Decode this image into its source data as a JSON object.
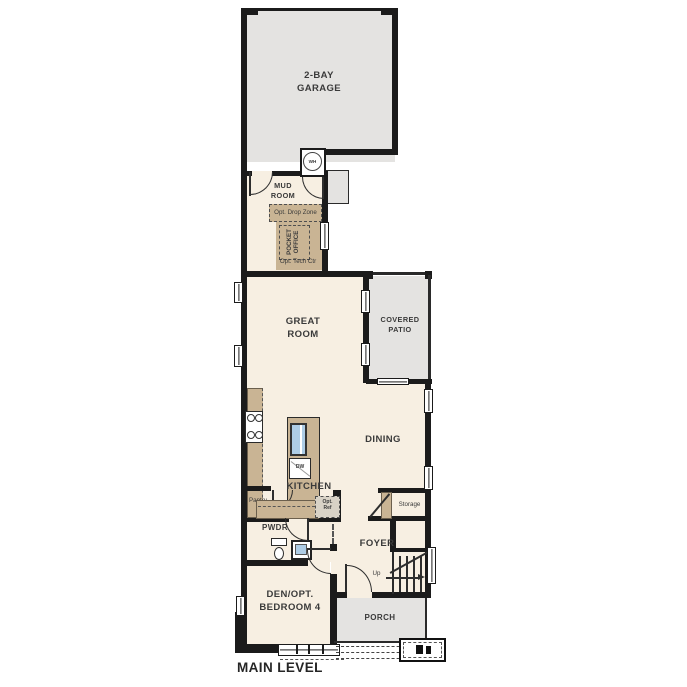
{
  "plan": {
    "level_label": "MAIN LEVEL",
    "labels": {
      "garage": "2-BAY\nGARAGE",
      "wh": "WH",
      "mud_room": "MUD\nROOM",
      "drop_zone": "Opt. Drop Zone",
      "pocket_office": "POCKET\nOFFICE",
      "tech_center": "Opt. Tech Ctr",
      "great_room": "GREAT\nROOM",
      "covered_patio": "COVERED\nPATIO",
      "kitchen": "KITCHEN",
      "pantry": "Pantry",
      "dw": "DW",
      "opt_ref": "Opt.\nRef",
      "dining": "DINING",
      "storage": "Storage",
      "pwdr": "PWDR",
      "foyer": "FOYER",
      "up": "Up",
      "den": "DEN/OPT.\nBEDROOM 4",
      "porch": "PORCH"
    },
    "colors": {
      "wall": "#1b1b1b",
      "room-fill": "#f7efe2",
      "outdoor-fill": "#e4e3e1",
      "casework-fill": "#c9b494",
      "sink-fill": "#aecde6",
      "label-ink": "#3a3a3a"
    }
  }
}
